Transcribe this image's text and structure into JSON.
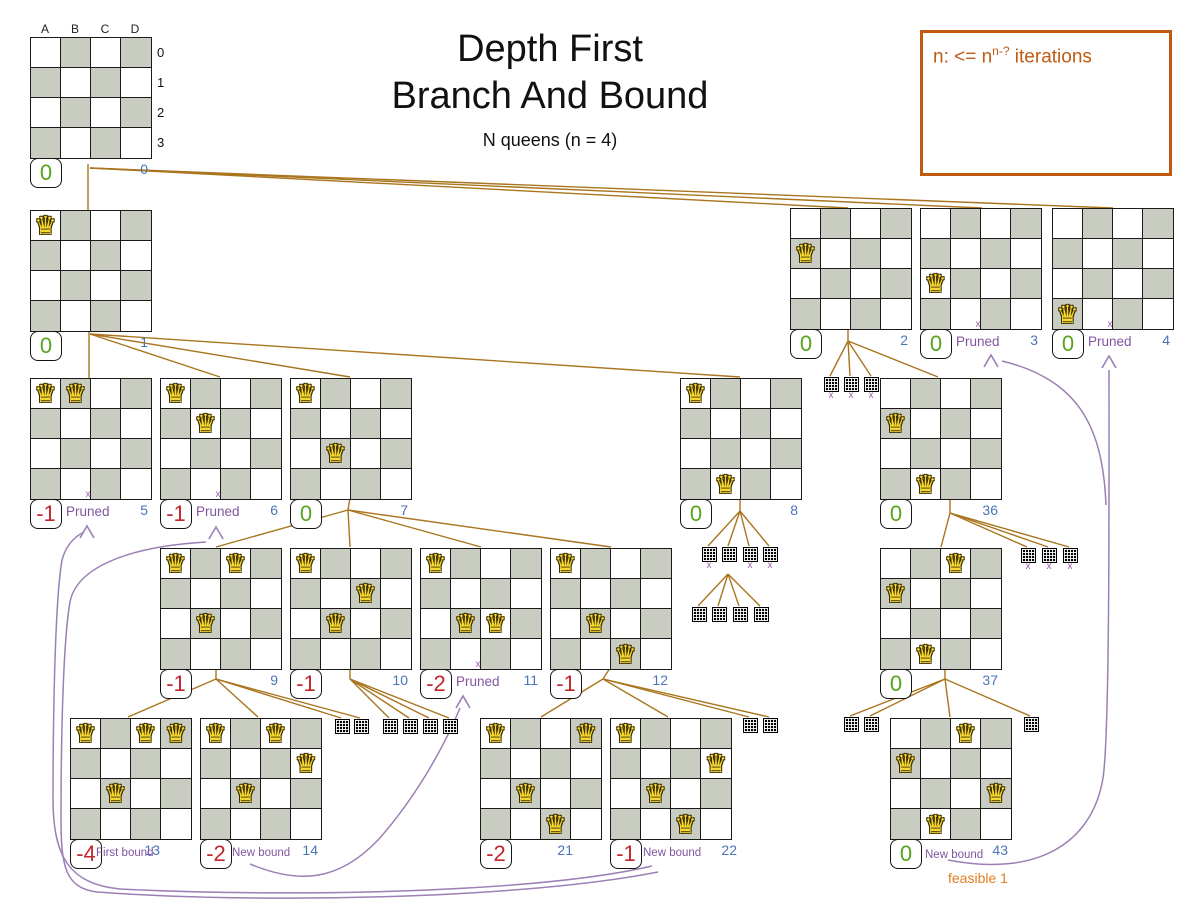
{
  "title": {
    "line1": "Depth First",
    "line2": "Branch And Bound",
    "subtitle": "N queens (n = 4)"
  },
  "note_box": {
    "prefix": "n: <= n",
    "sup": "n-?",
    "suffix": " iterations"
  },
  "axis": {
    "cols": [
      "A",
      "B",
      "C",
      "D"
    ],
    "rows": [
      "0",
      "1",
      "2",
      "3"
    ]
  },
  "glyphs": {
    "queen": "♛",
    "xmark": "x"
  },
  "colors": {
    "edge": "#a9751e",
    "curve": "#9b7fb6",
    "pruned_label": "#8155a0",
    "node_id": "#4a74b8",
    "score_zero": "#57a41c",
    "score_negative": "#c1272d",
    "note": "#c05a10",
    "feasible": "#e07f1e",
    "board_dark_cell": "#c9ccc0",
    "queen_fill": "#f6d832"
  },
  "nodes": [
    {
      "id": "0",
      "x": 30,
      "y": 37,
      "queens": [],
      "score": "0",
      "root": true
    },
    {
      "id": "1",
      "x": 30,
      "y": 210,
      "queens": [
        [
          0,
          0
        ]
      ],
      "score": "0"
    },
    {
      "id": "2",
      "x": 790,
      "y": 208,
      "queens": [
        [
          0,
          1
        ]
      ],
      "score": "0"
    },
    {
      "id": "3",
      "x": 920,
      "y": 208,
      "queens": [
        [
          0,
          2
        ]
      ],
      "score": "0",
      "label": "Pruned",
      "pruned": true
    },
    {
      "id": "4",
      "x": 1052,
      "y": 208,
      "queens": [
        [
          0,
          3
        ]
      ],
      "score": "0",
      "label": "Pruned",
      "pruned": true
    },
    {
      "id": "5",
      "x": 30,
      "y": 378,
      "queens": [
        [
          0,
          0
        ],
        [
          1,
          0
        ]
      ],
      "score": "-1",
      "label": "Pruned",
      "pruned": true
    },
    {
      "id": "6",
      "x": 160,
      "y": 378,
      "queens": [
        [
          0,
          0
        ],
        [
          1,
          1
        ]
      ],
      "score": "-1",
      "label": "Pruned",
      "pruned": true
    },
    {
      "id": "7",
      "x": 290,
      "y": 378,
      "queens": [
        [
          0,
          0
        ],
        [
          1,
          2
        ]
      ],
      "score": "0"
    },
    {
      "id": "8",
      "x": 680,
      "y": 378,
      "queens": [
        [
          0,
          0
        ],
        [
          1,
          3
        ]
      ],
      "score": "0"
    },
    {
      "id": "36",
      "x": 880,
      "y": 378,
      "queens": [
        [
          0,
          1
        ],
        [
          1,
          3
        ]
      ],
      "score": "0"
    },
    {
      "id": "9",
      "x": 160,
      "y": 548,
      "queens": [
        [
          0,
          0
        ],
        [
          2,
          0
        ],
        [
          1,
          2
        ]
      ],
      "score": "-1"
    },
    {
      "id": "10",
      "x": 290,
      "y": 548,
      "queens": [
        [
          0,
          0
        ],
        [
          2,
          1
        ],
        [
          1,
          2
        ]
      ],
      "score": "-1"
    },
    {
      "id": "11",
      "x": 420,
      "y": 548,
      "queens": [
        [
          0,
          0
        ],
        [
          1,
          2
        ],
        [
          2,
          2
        ]
      ],
      "score": "-2",
      "label": "Pruned",
      "pruned": true
    },
    {
      "id": "12",
      "x": 550,
      "y": 548,
      "queens": [
        [
          0,
          0
        ],
        [
          1,
          2
        ],
        [
          2,
          3
        ]
      ],
      "score": "-1"
    },
    {
      "id": "37",
      "x": 880,
      "y": 548,
      "queens": [
        [
          2,
          0
        ],
        [
          0,
          1
        ],
        [
          1,
          3
        ]
      ],
      "score": "0"
    },
    {
      "id": "13",
      "x": 70,
      "y": 718,
      "queens": [
        [
          0,
          0
        ],
        [
          2,
          0
        ],
        [
          3,
          0
        ],
        [
          1,
          2
        ]
      ],
      "score": "-4",
      "label": "First bound",
      "small": true,
      "lx": 26,
      "ly": 129,
      "idx": 60
    },
    {
      "id": "14",
      "x": 200,
      "y": 718,
      "queens": [
        [
          0,
          0
        ],
        [
          2,
          0
        ],
        [
          3,
          1
        ],
        [
          1,
          2
        ]
      ],
      "score": "-2",
      "label": "New bound",
      "small": true,
      "lx": 32,
      "ly": 129
    },
    {
      "id": "21",
      "x": 480,
      "y": 718,
      "queens": [
        [
          0,
          0
        ],
        [
          3,
          0
        ],
        [
          1,
          2
        ],
        [
          2,
          3
        ]
      ],
      "score": "-2",
      "idx": 63
    },
    {
      "id": "22",
      "x": 610,
      "y": 718,
      "queens": [
        [
          0,
          0
        ],
        [
          3,
          1
        ],
        [
          1,
          2
        ],
        [
          2,
          3
        ]
      ],
      "score": "-1",
      "label": "New bound",
      "small": true,
      "lx": 33,
      "ly": 129,
      "idx": 97
    },
    {
      "id": "43",
      "x": 890,
      "y": 718,
      "queens": [
        [
          2,
          0
        ],
        [
          0,
          1
        ],
        [
          3,
          2
        ],
        [
          1,
          3
        ]
      ],
      "score": "0",
      "label": "New bound",
      "small": true,
      "lx": 35,
      "ly": 131,
      "sublabel": "feasible 1"
    }
  ],
  "icons": [
    {
      "x": 824,
      "y": 377,
      "xmark": true
    },
    {
      "x": 844,
      "y": 377,
      "xmark": true
    },
    {
      "x": 864,
      "y": 377,
      "xmark": true
    },
    {
      "x": 702,
      "y": 547,
      "xmark": true
    },
    {
      "x": 722,
      "y": 547,
      "xmark": false
    },
    {
      "x": 743,
      "y": 547,
      "xmark": true
    },
    {
      "x": 763,
      "y": 547,
      "xmark": true
    },
    {
      "x": 692,
      "y": 607,
      "xmark": false
    },
    {
      "x": 712,
      "y": 607,
      "xmark": false
    },
    {
      "x": 733,
      "y": 607,
      "xmark": false
    },
    {
      "x": 754,
      "y": 607,
      "xmark": false
    },
    {
      "x": 1021,
      "y": 548,
      "xmark": true
    },
    {
      "x": 1042,
      "y": 548,
      "xmark": true
    },
    {
      "x": 1063,
      "y": 548,
      "xmark": true
    },
    {
      "x": 335,
      "y": 719,
      "xmark": false
    },
    {
      "x": 354,
      "y": 719,
      "xmark": false
    },
    {
      "x": 383,
      "y": 719,
      "xmark": false
    },
    {
      "x": 403,
      "y": 719,
      "xmark": false
    },
    {
      "x": 423,
      "y": 719,
      "xmark": false
    },
    {
      "x": 443,
      "y": 719,
      "xmark": false
    },
    {
      "x": 743,
      "y": 718,
      "xmark": false
    },
    {
      "x": 763,
      "y": 718,
      "xmark": false
    },
    {
      "x": 844,
      "y": 717,
      "xmark": false
    },
    {
      "x": 864,
      "y": 717,
      "xmark": false
    },
    {
      "x": 1024,
      "y": 717,
      "xmark": false
    }
  ],
  "edges": [
    [
      88,
      164,
      88,
      210
    ],
    [
      90,
      168,
      848,
      208
    ],
    [
      90,
      168,
      982,
      208
    ],
    [
      90,
      168,
      1113,
      208
    ],
    [
      89,
      330,
      89,
      378
    ],
    [
      90,
      334,
      220,
      377
    ],
    [
      90,
      334,
      350,
      377
    ],
    [
      90,
      334,
      740,
      377
    ],
    [
      848,
      330,
      848,
      341
    ],
    [
      848,
      341,
      830,
      376
    ],
    [
      848,
      341,
      850,
      376
    ],
    [
      848,
      341,
      871,
      376
    ],
    [
      848,
      341,
      938,
      377
    ],
    [
      350,
      498,
      348,
      510
    ],
    [
      348,
      510,
      216,
      547
    ],
    [
      348,
      510,
      350,
      547
    ],
    [
      348,
      510,
      481,
      547
    ],
    [
      348,
      510,
      611,
      547
    ],
    [
      740,
      498,
      740,
      511
    ],
    [
      740,
      511,
      708,
      546
    ],
    [
      740,
      511,
      728,
      546
    ],
    [
      740,
      511,
      749,
      546
    ],
    [
      740,
      511,
      769,
      546
    ],
    [
      728,
      574,
      698,
      606
    ],
    [
      728,
      574,
      718,
      606
    ],
    [
      728,
      574,
      739,
      606
    ],
    [
      728,
      574,
      760,
      606
    ],
    [
      950,
      498,
      950,
      513
    ],
    [
      950,
      513,
      941,
      547
    ],
    [
      950,
      513,
      1027,
      547
    ],
    [
      950,
      513,
      1048,
      547
    ],
    [
      950,
      513,
      1069,
      547
    ],
    [
      216,
      668,
      216,
      679
    ],
    [
      216,
      679,
      128,
      717
    ],
    [
      216,
      679,
      258,
      717
    ],
    [
      216,
      679,
      341,
      718
    ],
    [
      216,
      679,
      360,
      718
    ],
    [
      350,
      668,
      350,
      679
    ],
    [
      350,
      679,
      389,
      718
    ],
    [
      350,
      679,
      409,
      718
    ],
    [
      350,
      679,
      429,
      718
    ],
    [
      350,
      679,
      449,
      718
    ],
    [
      610,
      668,
      603,
      679
    ],
    [
      603,
      679,
      541,
      717
    ],
    [
      603,
      679,
      668,
      717
    ],
    [
      603,
      679,
      749,
      717
    ],
    [
      603,
      679,
      769,
      717
    ],
    [
      945,
      668,
      945,
      679
    ],
    [
      945,
      679,
      850,
      716
    ],
    [
      945,
      679,
      870,
      716
    ],
    [
      945,
      679,
      950,
      717
    ],
    [
      945,
      679,
      1030,
      716
    ]
  ],
  "curves": [
    {
      "path": "M 652 866 C 540 892, 300 898, 120 889 C 70 884, 53 858, 53 798 C 53 718, 55 600, 62 560 C 66 545, 74 537, 84 532",
      "tip": [
        87,
        526
      ]
    },
    {
      "path": "M 658 872 C 520 899, 260 904, 97 892 C 65 888, 61 866, 61 818 C 61 740, 63 642, 70 602 C 76 570, 122 547, 206 542",
      "tip": [
        216,
        527
      ]
    },
    {
      "path": "M 250 864 C 298 884, 338 882, 378 840 C 412 802, 442 752, 460 708",
      "tip": [
        463,
        696
      ]
    },
    {
      "path": "M 948 860 C 1035 877, 1092 845, 1103 778 C 1110 733, 1109 480, 1109 370",
      "tip": [
        1109,
        356
      ]
    },
    {
      "path": "M 1106 505 C 1103 432, 1082 380, 1002 361",
      "tip": [
        991,
        355
      ]
    }
  ]
}
